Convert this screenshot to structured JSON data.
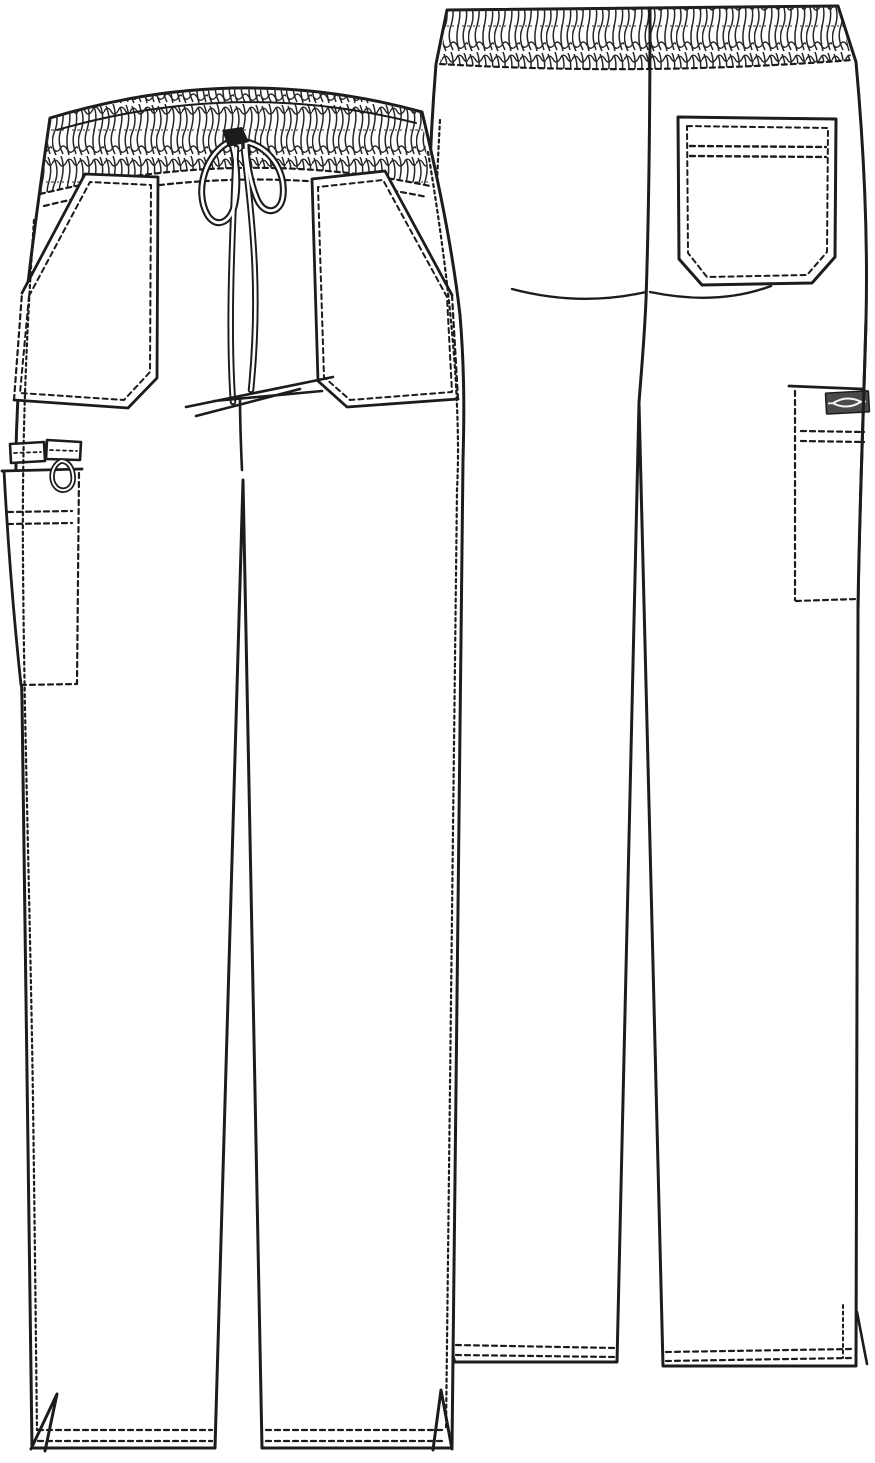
{
  "figure": {
    "kind": "technical-flat-sketch",
    "subject": "drawstring cargo scrub pants, front and back views",
    "colors": {
      "background": "#ffffff",
      "line": "#1c1c1e",
      "label_background": "#4a4a4c",
      "label_mark": "#f5f5f5"
    },
    "views": [
      {
        "name": "front",
        "features": [
          "elastic shirred waistband",
          "center-front drawstring bow with hanging ties",
          "slanted patch hand pocket left",
          "slanted patch hand pocket right",
          "left leg cargo pocket with double topstitch rows",
          "webbing tab with instrument loop above cargo pocket",
          "side seam topstitching",
          "double-needle hems with side vents"
        ]
      },
      {
        "name": "back",
        "features": [
          "elastic shirred waistband",
          "center-back seam",
          "seat yoke curve",
          "back patch pocket with topstitching",
          "right leg side cargo pocket with brand label",
          "double-needle hems with side vents"
        ]
      }
    ],
    "brand_label": {
      "name": "dickies-logo-label",
      "mark": "horizontal-lens-emblem"
    }
  }
}
